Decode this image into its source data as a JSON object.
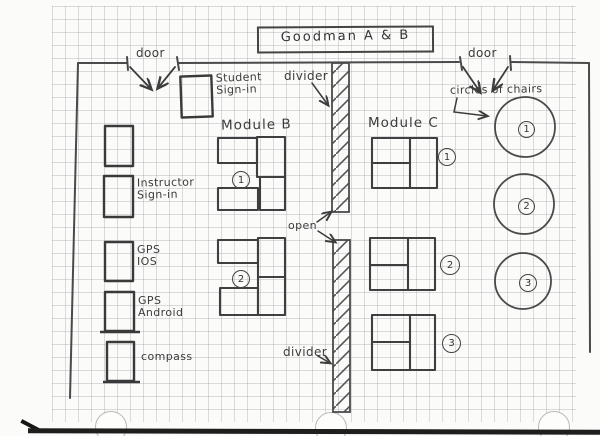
{
  "page": {
    "title": "Goodman A & B"
  },
  "labels": {
    "door_left": "door",
    "door_right": "door",
    "student_signin": "Student\nSign-in",
    "instructor_signin": "Instructor\nSign-in",
    "gps_ios": "GPS\nIOS",
    "gps_android": "GPS\nAndroid",
    "compass": "compass",
    "divider_top": "divider",
    "divider_bottom": "divider",
    "open": "open",
    "circles_of_chairs": "circles of chairs",
    "module_b": "Module B",
    "module_c": "Module C"
  },
  "module_b": {
    "groups": [
      {
        "number": "1"
      },
      {
        "number": "2"
      }
    ]
  },
  "module_c": {
    "tables": [
      {
        "number": "1"
      },
      {
        "number": "2"
      },
      {
        "number": "3"
      }
    ]
  },
  "chair_circles": [
    {
      "number": "1"
    },
    {
      "number": "2"
    },
    {
      "number": "3"
    }
  ]
}
